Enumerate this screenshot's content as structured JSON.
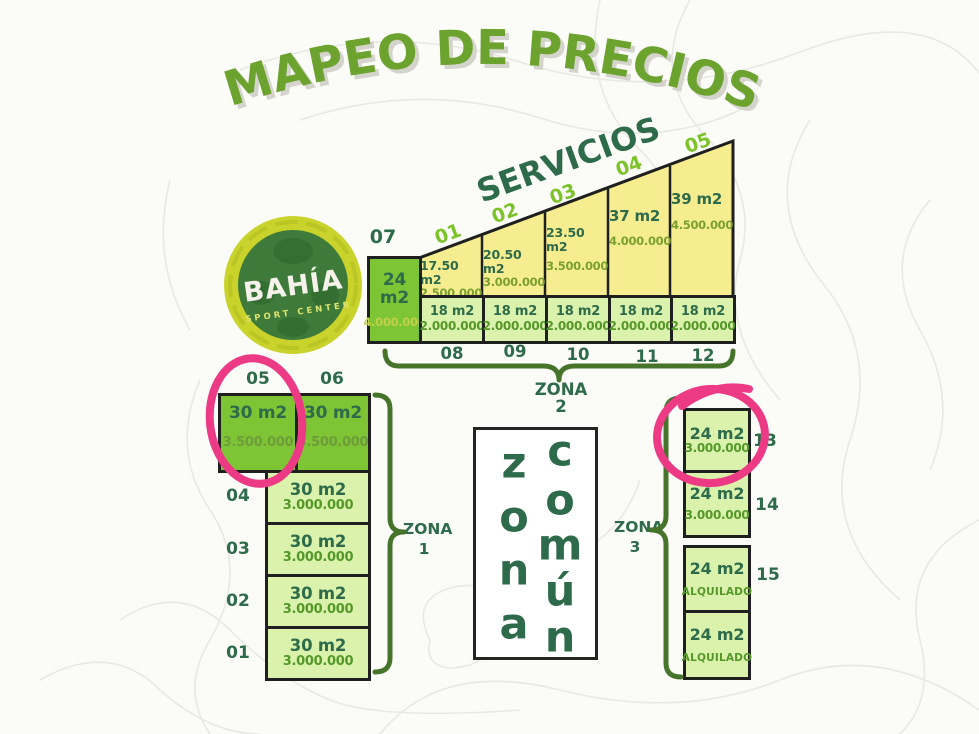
{
  "title": "MAPEO DE PRECIOS",
  "logo": {
    "name": "BAHÍA",
    "subtitle": "SPORT CENTER"
  },
  "servicios": {
    "label": "SERVICIOS",
    "lot07": {
      "id": "07",
      "size": "24 m2",
      "price": "4.000.000"
    },
    "upper_lots": [
      {
        "id": "01",
        "size": "17.50 m2",
        "price": "2.500.000"
      },
      {
        "id": "02",
        "size": "20.50 m2",
        "price": "3.000.000"
      },
      {
        "id": "03",
        "size": "23.50 m2",
        "price": "3.500.000"
      },
      {
        "id": "04",
        "size": "37 m2",
        "price": "4.000.000"
      },
      {
        "id": "05",
        "size": "39 m2",
        "price": "4.500.000"
      }
    ],
    "lower_lots": [
      {
        "id": "08",
        "size": "18 m2",
        "price": "2.000.000"
      },
      {
        "id": "09",
        "size": "18 m2",
        "price": "2.000.000"
      },
      {
        "id": "10",
        "size": "18 m2",
        "price": "2.000.000"
      },
      {
        "id": "11",
        "size": "18 m2",
        "price": "2.000.000"
      },
      {
        "id": "12",
        "size": "18 m2",
        "price": "2.000.000"
      }
    ]
  },
  "zona1": {
    "brace_label": {
      "word": "ZONA",
      "number": "1"
    },
    "row_lots": [
      {
        "id": "05",
        "size": "30 m2",
        "price": "3.500.000"
      },
      {
        "id": "06",
        "size": "30 m2",
        "price": "3.500.000"
      }
    ],
    "stacked_lots": [
      {
        "id": "04",
        "size": "30 m2",
        "price": "3.000.000"
      },
      {
        "id": "03",
        "size": "30 m2",
        "price": "3.000.000"
      },
      {
        "id": "02",
        "size": "30 m2",
        "price": "3.000.000"
      },
      {
        "id": "01",
        "size": "30 m2",
        "price": "3.000.000"
      }
    ]
  },
  "zona2": {
    "label": "ZONA 2"
  },
  "zona_comun": {
    "letters1": [
      "z",
      "o",
      "n",
      "a"
    ],
    "letters2": [
      "c",
      "o",
      "m",
      "ú",
      "n"
    ]
  },
  "zona3": {
    "brace_label": {
      "word": "ZONA",
      "number": "3"
    },
    "lots": [
      {
        "id": "13",
        "size": "24 m2",
        "price": "3.000.000"
      },
      {
        "id": "14",
        "size": "24 m2",
        "price": "3.000.000"
      },
      {
        "id": "15",
        "size": "24 m2",
        "price": "ALQUILADO"
      },
      {
        "size": "24 m2",
        "price": "ALQUILADO"
      }
    ]
  },
  "highlights": {
    "color": "#ec3a85",
    "circled_lots": [
      "zona1-05",
      "zona3-13"
    ]
  },
  "colors": {
    "title_green": "#6ba32e",
    "dark_green": "#2e6b4a",
    "bright_green": "#7dc535",
    "light_green": "#daf2ac",
    "yellow": "#f5ed90",
    "label_green": "#7cc229",
    "price_green": "#55982a",
    "brace_green": "#47742b"
  }
}
